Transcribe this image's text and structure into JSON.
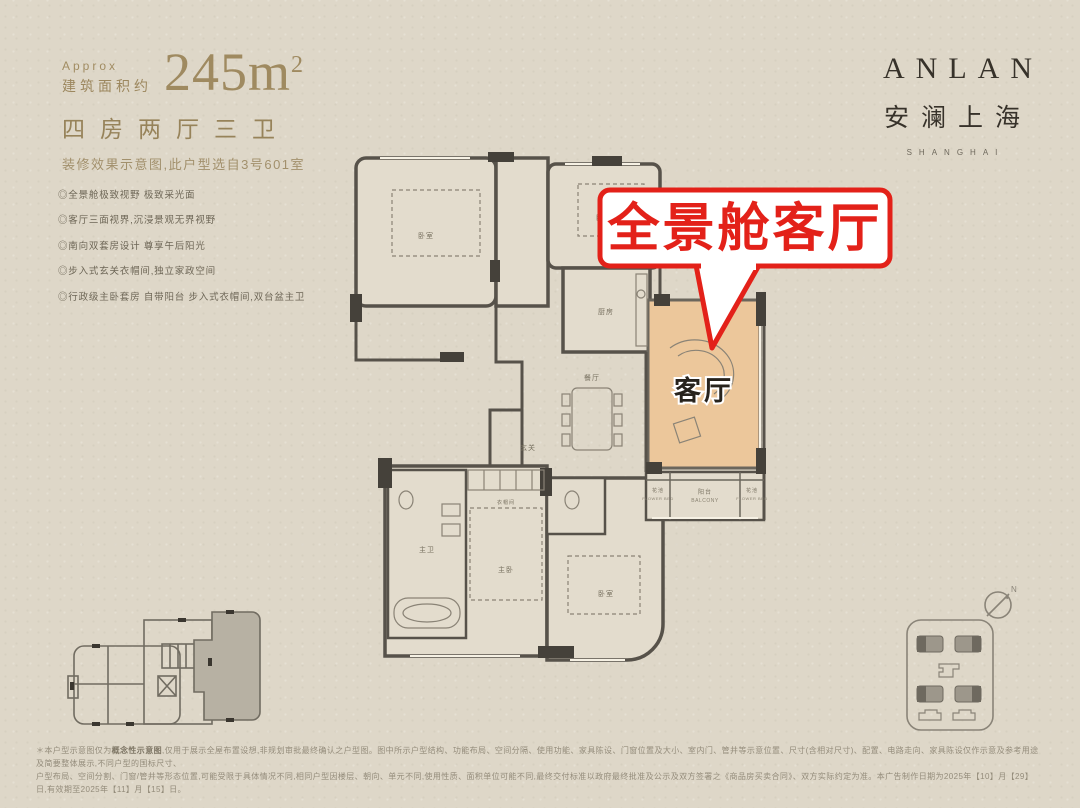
{
  "spec": {
    "approx_label": "Approx",
    "area_label": "建筑面积约",
    "area_value": "245m",
    "area_sup": "2",
    "layout_line": "四房两厅三卫",
    "subtitle": "装修效果示意图,此户型选自3号601室",
    "features": [
      "◎全景舱极致视野 极致采光面",
      "◎客厅三面视界,沉浸景观无界视野",
      "◎南向双套房设计 尊享午后阳光",
      "◎步入式玄关衣帽间,独立家政空间",
      "◎行政级主卧套房 自带阳台 步入式衣帽间,双台盆主卫"
    ]
  },
  "logo": {
    "en": "ANLAN",
    "cn": "安澜上海",
    "sub": "SHANGHAI"
  },
  "callout": {
    "label": "全景舱客厅",
    "color": "#e32119"
  },
  "floorplan": {
    "highlight_color": "#ecc79b",
    "labels": {
      "living": "客厅",
      "balcony_cn": "阳台",
      "balcony_en": "BALCONY",
      "flower_cn": "花池",
      "flower_en": "FLOWER BED",
      "dining": "餐厅",
      "kitchen": "厨房",
      "master": "主卧",
      "master_bath": "主卫",
      "bedroom": "卧室",
      "foyer": "玄关",
      "cloak": "衣帽间"
    }
  },
  "compass": {
    "label": "N"
  },
  "footer": {
    "line1_pre": "＊本户型示意图仅为",
    "line1_bold": "概念性示意图",
    "line1_post": ",仅用于展示全屋布置设想,非规划审批最终确认之户型图。图中所示户型结构、功能布局、空间分隔、使用功能、家具陈设、门窗位置及大小、室内门、管井等示意位置、尺寸(含相对尺寸)、配置、电路走向、家具陈设仅作示意及参考用途及简要整体展示,不同户型的国标尺寸、",
    "line2": "户型布局、空间分割、门窗/管井等形态位置,可能受限于具体情况不同,相同户型因楼层、朝向、单元不同,使用性质、面积单位可能不同,最终交付标准以政府最终批准及公示及双方签署之《商品房买卖合同》、双方实际约定为准。本广告制作日期为2025年【10】月【29】日,有效期至2025年【11】月【15】日。"
  }
}
